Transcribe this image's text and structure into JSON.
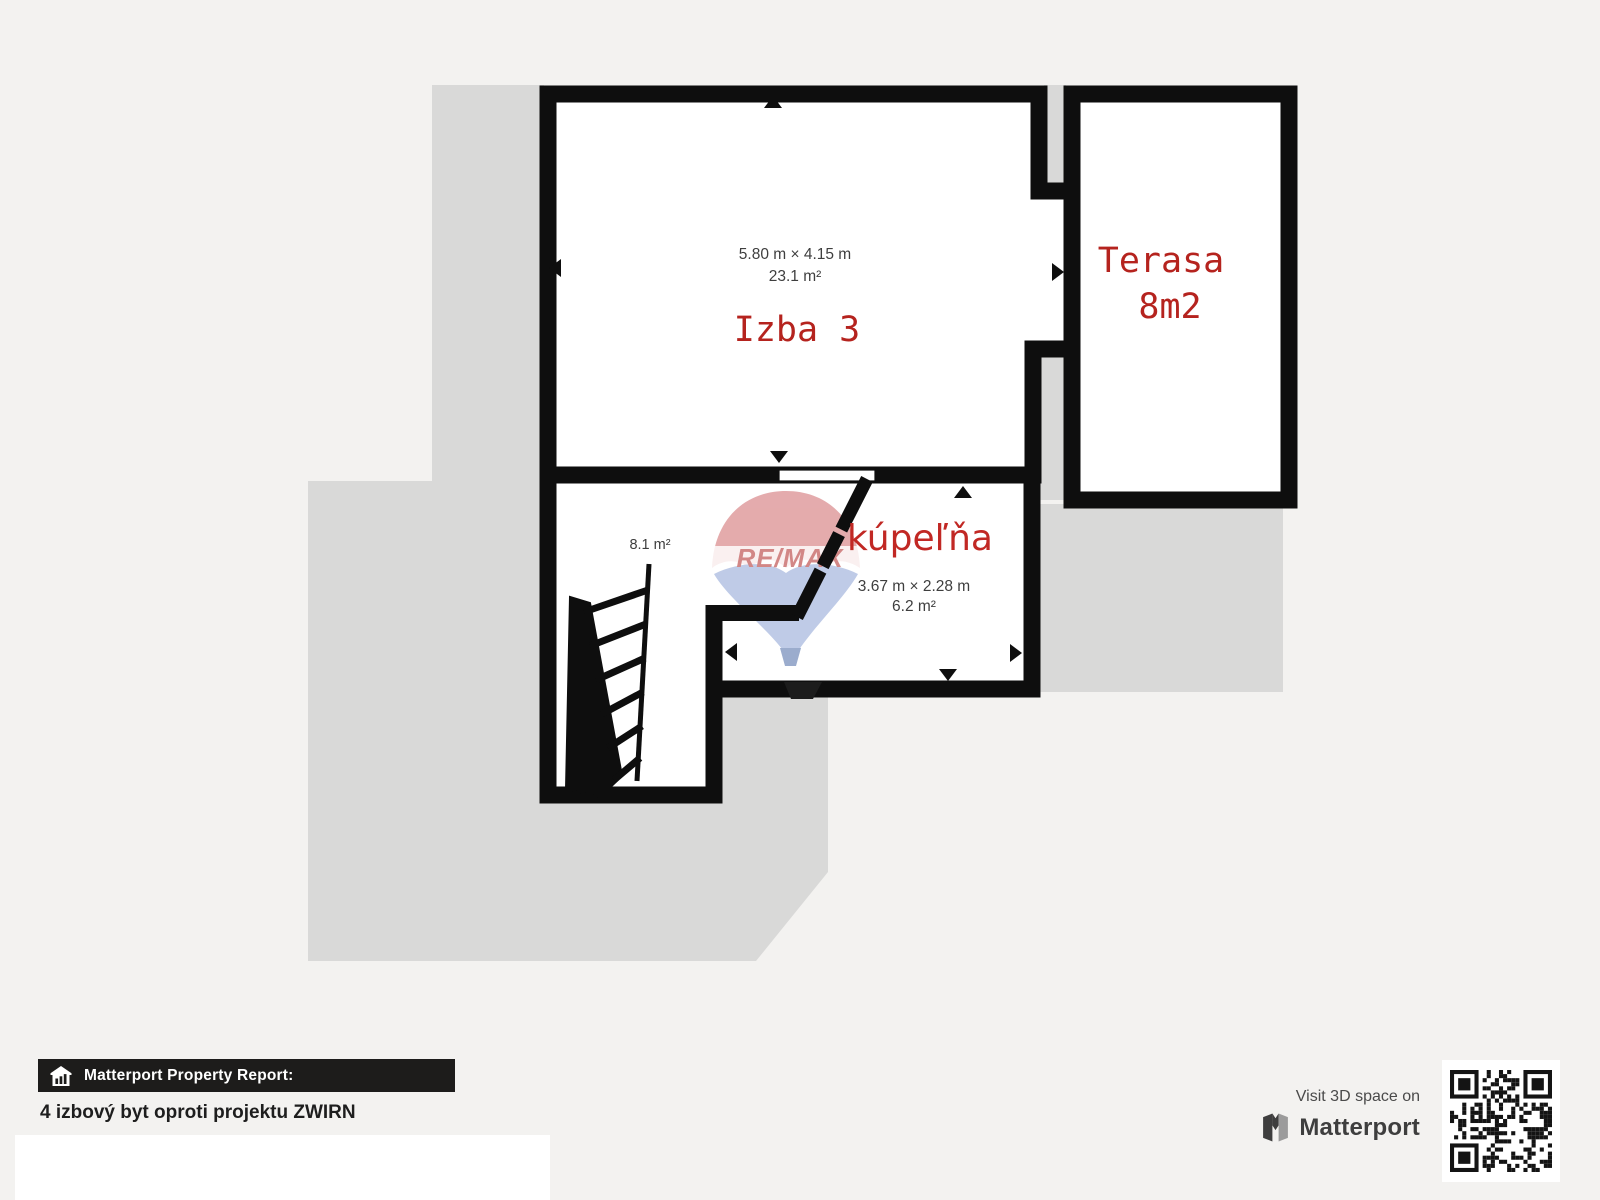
{
  "plan": {
    "izba3": {
      "label": "Izba 3",
      "dims": "5.80 m × 4.15 m",
      "area": "23.1 m²"
    },
    "terasa": {
      "label": "Terasa",
      "area": "8m2"
    },
    "kupelna": {
      "label": "kúpeľňa",
      "dims": "3.67 m × 2.28 m",
      "area": "6.2 m²"
    },
    "stairs_room": {
      "area": "8.1 m²"
    },
    "watermark": {
      "text": "RE/MAX"
    },
    "colors": {
      "wall": "#0e0e0e",
      "underlay": "#d9d9d8",
      "room_fill": "#ffffff",
      "label_red": "#b5231e",
      "kupelna_red": "#c12824",
      "dim_gray": "#3e3e3e",
      "watermark_red": "#e2a4a6",
      "watermark_blue": "#bac7e5"
    }
  },
  "footer": {
    "report_label": "Matterport Property Report:",
    "property_title": "4 izbový byt oproti projektu ZWIRN",
    "visit_text": "Visit 3D space on",
    "brand": "Matterport",
    "icons": {
      "bar_icon": "house-icon",
      "brand_icon": "matterport-logo-icon",
      "qr": "qr-code"
    },
    "bar_color": "#1d1c1b"
  }
}
